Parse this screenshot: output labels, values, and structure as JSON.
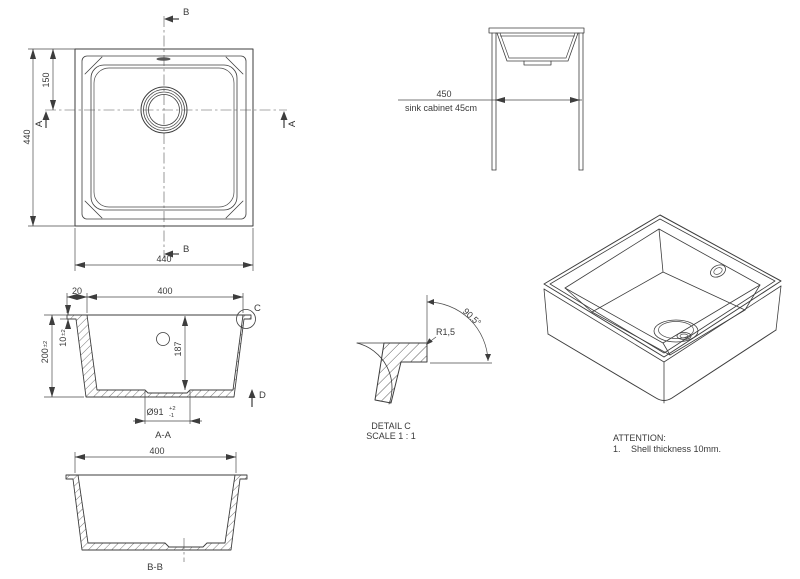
{
  "drawing": {
    "top_view": {
      "section_label_b": "B",
      "section_label_a": "A",
      "dim_overall_width": "440",
      "dim_overall_height": "440",
      "dim_drain_offset": "150"
    },
    "cabinet_view": {
      "dim_cabinet_width": "450",
      "cabinet_note": "sink cabinet 45cm"
    },
    "section_aa": {
      "dim_rim_width": "20",
      "dim_opening_width": "400",
      "dim_rim_thickness": "10",
      "dim_rim_thickness_tol": "±2",
      "dim_overall_depth": "200",
      "dim_overall_depth_tol": "±2",
      "dim_bowl_depth": "187",
      "dim_drain_diameter": "Ø91",
      "dim_drain_tol_plus": "+2",
      "dim_drain_tol_minus": "-1",
      "detail_marker": "C",
      "direction_marker": "D",
      "title": "A-A"
    },
    "detail_c": {
      "dim_angle": "90.5°",
      "dim_radius": "R1,5",
      "title": "DETAIL C",
      "scale": "SCALE 1 : 1"
    },
    "section_bb": {
      "dim_opening_width": "400",
      "title": "B-B"
    },
    "notes": {
      "heading": "ATTENTION:",
      "item_1_number": "1.",
      "item_1_text": "Shell thickness 10mm."
    }
  }
}
